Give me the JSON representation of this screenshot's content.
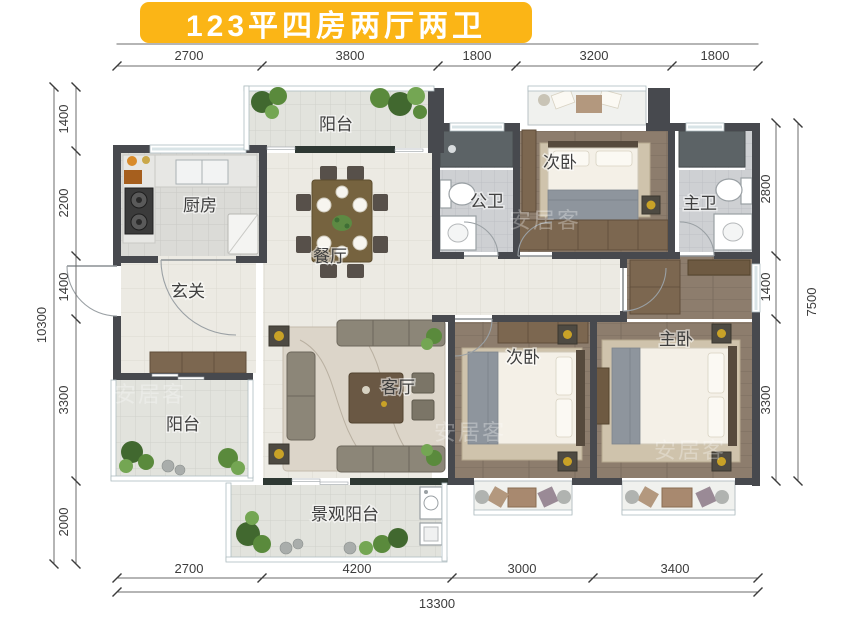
{
  "title": "123平四房两厅两卫",
  "watermark": "安居客",
  "rooms": {
    "balcony_top": "阳台",
    "kitchen": "厨房",
    "dining": "餐厅",
    "public_bath": "公卫",
    "bedroom_second_top": "次卧",
    "master_bath": "主卫",
    "foyer": "玄关",
    "balcony_left": "阳台",
    "living": "客厅",
    "bedroom_second_bottom": "次卧",
    "master_bedroom": "主卧",
    "landscape_balcony": "景观阳台"
  },
  "dimensions": {
    "top": [
      "2700",
      "3800",
      "1800",
      "3200",
      "1800"
    ],
    "bottom": [
      "2700",
      "4200",
      "3000",
      "3400"
    ],
    "bottom_total": "13300",
    "left": [
      "1400",
      "2200",
      "1400",
      "3300",
      "2000"
    ],
    "left_total": "10300",
    "right": [
      "2800",
      "1400",
      "3300"
    ],
    "right_total": "7500"
  },
  "colors": {
    "banner": "#FBB516",
    "wall": "#47494E",
    "wood_floor": "#8D7D6D",
    "tile_floor": "#ECEAE3",
    "bath_floor": "#CED0D3"
  }
}
